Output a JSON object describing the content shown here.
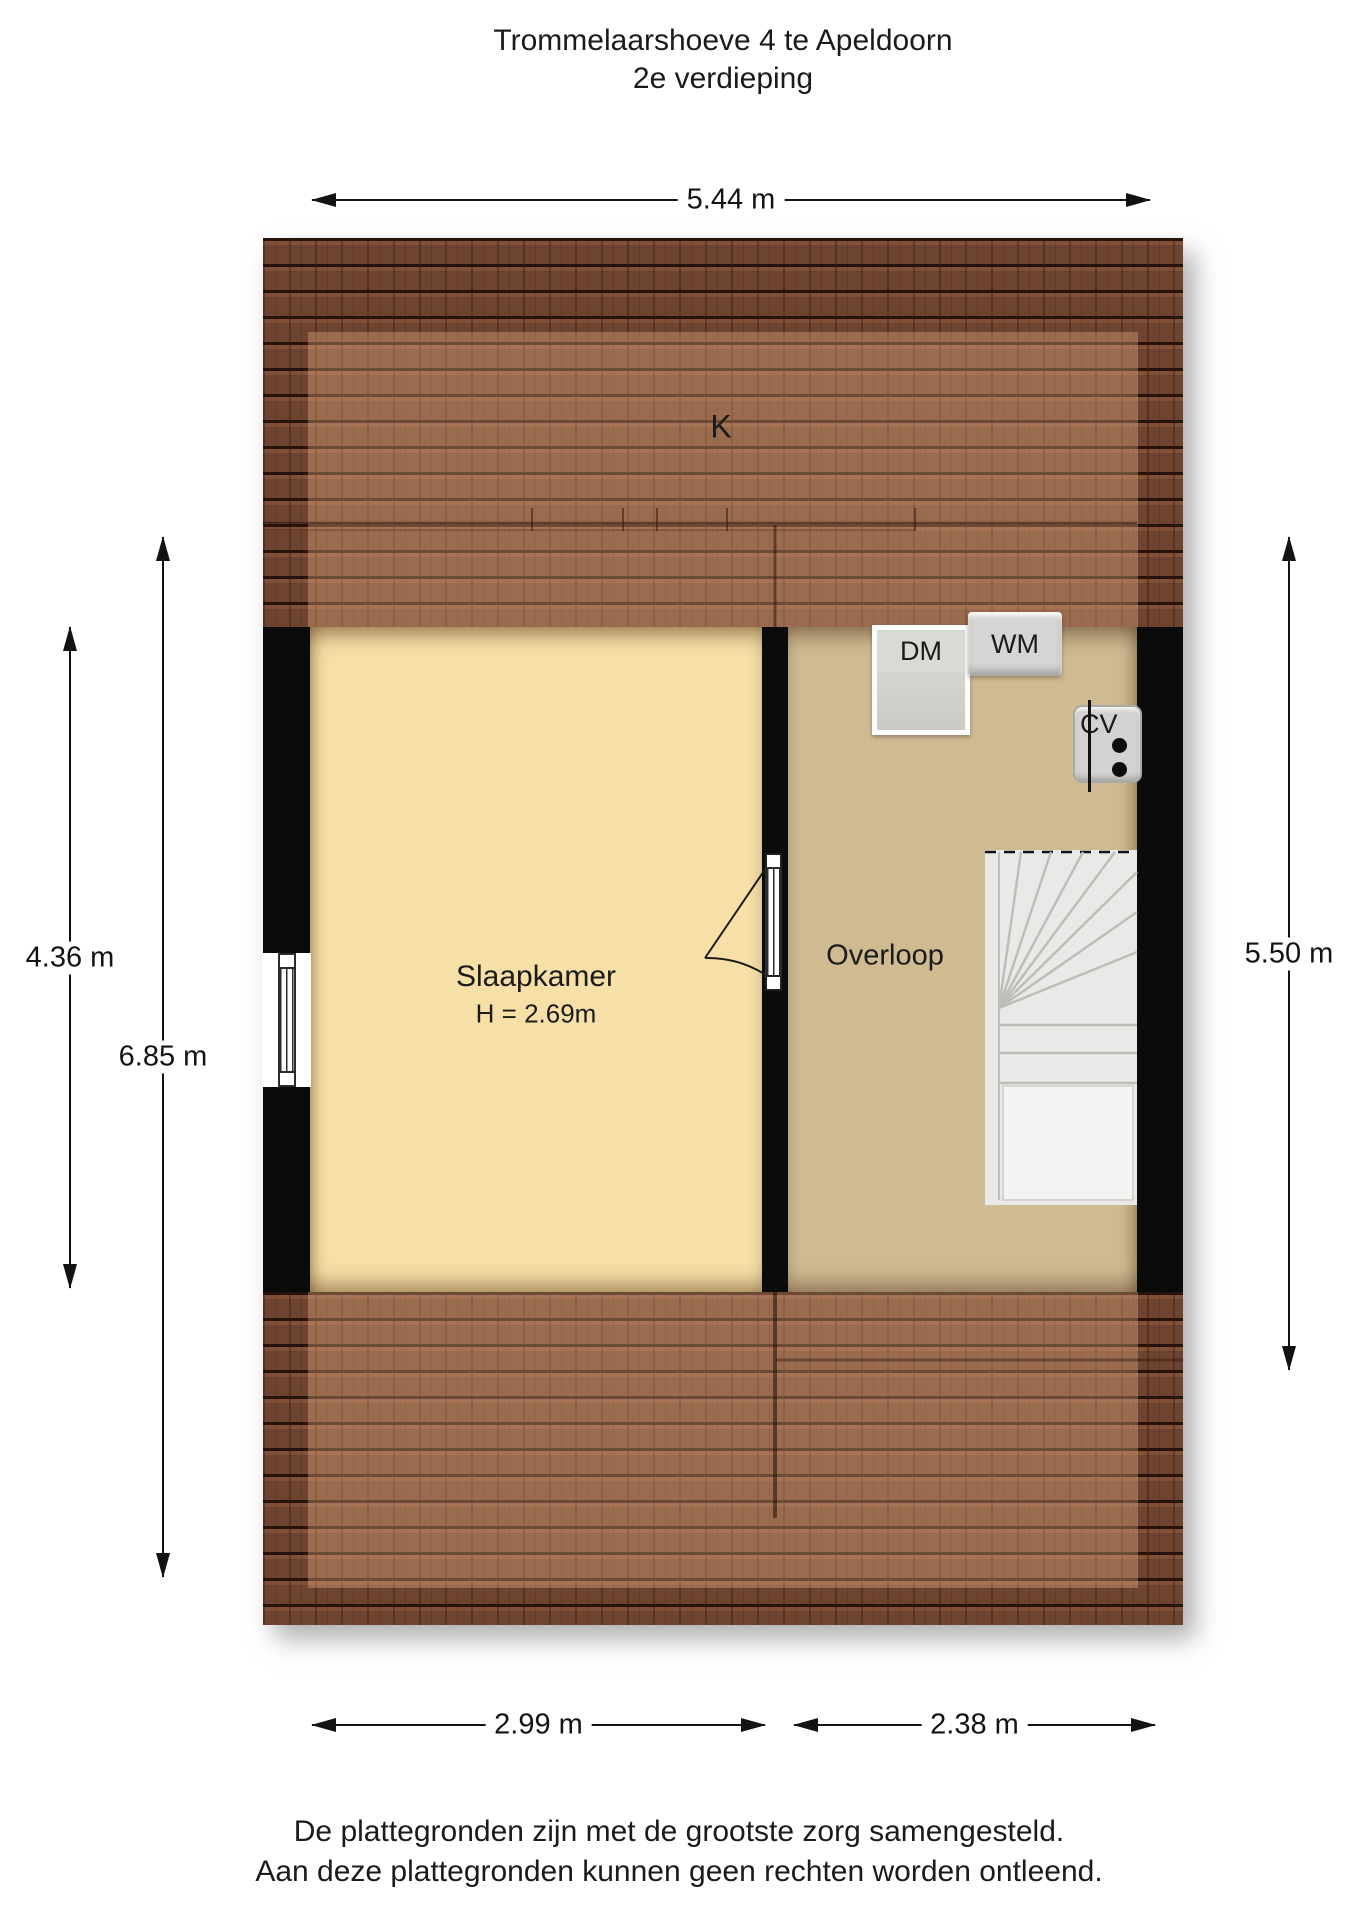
{
  "title": {
    "line1": "Trommelaarshoeve 4 te Apeldoorn",
    "line2": "2e verdieping"
  },
  "floorplan": {
    "roof_window_label": "K",
    "rooms": [
      {
        "name": "Slaapkamer",
        "ceiling_height": "H = 2.69m"
      },
      {
        "name": "Overloop"
      }
    ],
    "appliances": [
      {
        "label": "DM"
      },
      {
        "label": "WM"
      },
      {
        "label": "CV"
      }
    ]
  },
  "dimensions": {
    "top": "5.44 m",
    "left_inner": "4.36 m",
    "left_outer": "6.85 m",
    "right": "5.50 m",
    "bottom_left": "2.99 m",
    "bottom_right": "2.38 m"
  },
  "footer": {
    "line1": "De plattegronden zijn met de grootste zorg samengesteld.",
    "line2": "Aan deze plattegronden kunnen geen rechten worden ontleend."
  },
  "colors": {
    "slaapkamer_floor": "#f6e0a7",
    "overloop_floor": "#cfba92",
    "roof_base": "#6e4431",
    "roof_light": "#9c7052",
    "wall": "#0b0b0b",
    "appliance_grey": "#d6d5d3",
    "stair_grey": "#e9e9e7"
  }
}
